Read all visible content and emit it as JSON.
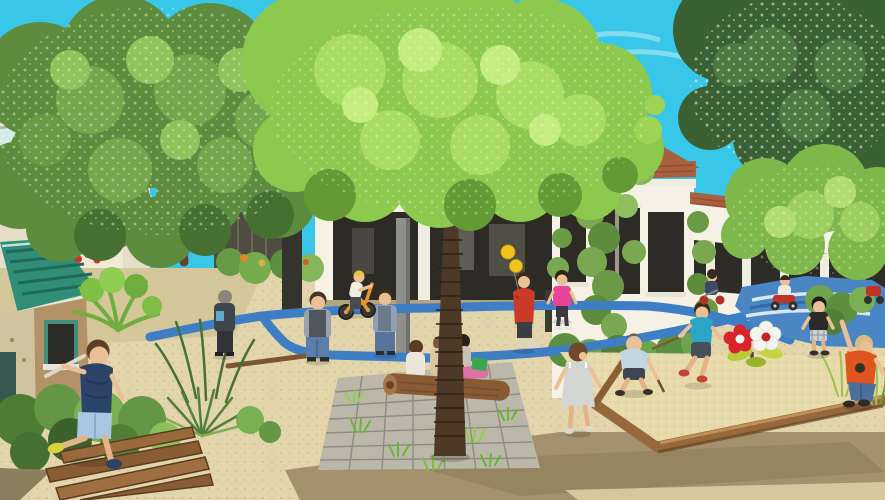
{
  "image": {
    "kind": "architectural-rendering",
    "subject": "children's courtyard playground with blue painted loop trike path",
    "visible_text": "none"
  },
  "palette": {
    "sky": "#38c7e9",
    "wall": "#f5f1e5",
    "wall_shadow": "#e6ddc8",
    "roof_tile": "#a8603f",
    "window_dark": "#2d2b26",
    "gravel": "#e2d5ab",
    "sand": "#e8dbab",
    "wet_sand": "#a3926d",
    "path_blue": "#3e7ec4",
    "path_patch": "#4a86c4",
    "paver": "#bcb8a9",
    "wood": "#96683c",
    "log": "#8a5a34",
    "playhouse_teal": "#2f8d78",
    "tree_left": "#5d8c3e",
    "tree_center": "#8cc94e",
    "tree_right_dark": "#3b6034",
    "tree_right_bright": "#7fb84a",
    "hedge": "#5c8f3f",
    "skin": "#ecc096"
  },
  "scene": {
    "sky": {
      "label": "clear cyan sky"
    },
    "trees": [
      {
        "label": "large dappled green tree, upper left"
      },
      {
        "label": "bright feathery green tree, center, trunk in paver plaza"
      },
      {
        "label": "dark white-speckled tree, top right"
      },
      {
        "label": "bright tree overhanging building, right"
      }
    ],
    "buildings": [
      {
        "label": "white stucco school building, red clay tile roof, vine-covered walls, dark wood windows (right)"
      },
      {
        "label": "glass patio-door wing seen between tree trunks (center background)"
      },
      {
        "label": "white building glimpsed through foliage (far left)"
      }
    ],
    "playground": {
      "path": "blue painted loop trike path on decomposed-granite yard",
      "paving": "gray unit pavers with grass joints around central tree",
      "sandpit": "timber-edged sand play area, right foreground",
      "planks": "wooden balance planks, lower left",
      "log_bench": "log bench beside paver plaza",
      "playhouse": "rustic playhouse with teal shingle roof and red garland, left",
      "spring_riders": "red flower and white flower spring riders",
      "garden": "ferns, yucca and shrubs planting beds"
    },
    "children": [
      {
        "id": "runner",
        "desc": "boy running over planks, navy tee, light-blue shorts, yellow shoe"
      },
      {
        "id": "observer",
        "desc": "child in dark jacket standing by plants, back turned"
      },
      {
        "id": "watcher-1",
        "desc": "boy in gray jacket and jeans, back turned"
      },
      {
        "id": "watcher-2",
        "desc": "boy in blue-gray top and jeans, back turned"
      },
      {
        "id": "bike-rider",
        "desc": "child with yellow cap on orange balance bike"
      },
      {
        "id": "balloon-kid",
        "desc": "child in red hoodie holding two yellow balloons"
      },
      {
        "id": "pink-girl",
        "desc": "girl in pink shirt and dark leggings"
      },
      {
        "id": "log-sitters",
        "desc": "three children sitting on log bench with pink blanket and green bag"
      },
      {
        "id": "sundress-girl",
        "desc": "girl in gray sundress walking right"
      },
      {
        "id": "digging-boy",
        "desc": "crouching boy in light blue shirt digging with stick"
      },
      {
        "id": "jumping-boy",
        "desc": "boy in teal tee jumping with stick, red shoes"
      },
      {
        "id": "toddler",
        "desc": "toddler in black tee and plaid shorts"
      },
      {
        "id": "reaching-boy",
        "desc": "boy in orange tee and jeans reaching up, on timber edge"
      },
      {
        "id": "trike-riders",
        "desc": "two small children on trikes on blue painted area"
      }
    ]
  }
}
